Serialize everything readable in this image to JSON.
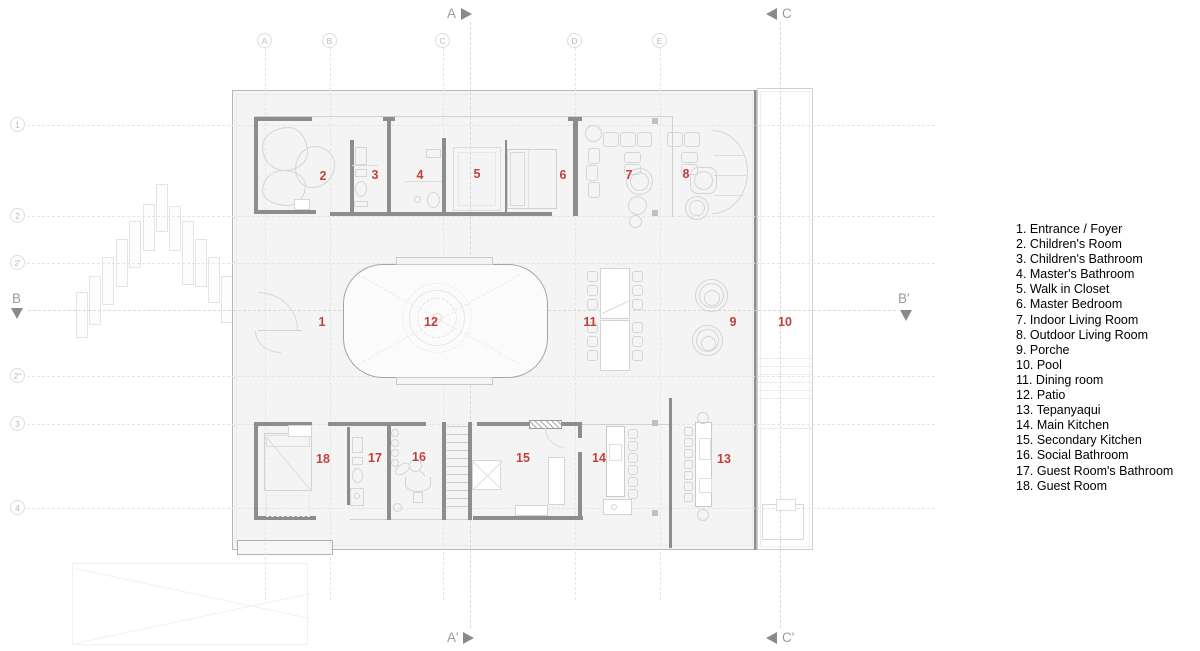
{
  "colors": {
    "room_number": "#c4403a",
    "wall": "#8d8d8d",
    "site_fill": "#f4f4f4",
    "grid_line": "#e5e5e5",
    "marker_text": "#9a9a9a"
  },
  "legend": {
    "items": [
      {
        "num": "1.",
        "label": "Entrance / Foyer"
      },
      {
        "num": "2.",
        "label": "Children's Room"
      },
      {
        "num": "3.",
        "label": "Children's Bathroom"
      },
      {
        "num": "4.",
        "label": "Master's Bathroom"
      },
      {
        "num": "5.",
        "label": "Walk in Closet"
      },
      {
        "num": "6.",
        "label": "Master Bedroom"
      },
      {
        "num": "7.",
        "label": "Indoor Living Room"
      },
      {
        "num": "8.",
        "label": "Outdoor Living Room"
      },
      {
        "num": "9.",
        "label": "Porche"
      },
      {
        "num": "10.",
        "label": "Pool"
      },
      {
        "num": "11.",
        "label": "Dining room"
      },
      {
        "num": "12.",
        "label": "Patio"
      },
      {
        "num": "13.",
        "label": "Tepanyaqui"
      },
      {
        "num": "14.",
        "label": "Main Kitchen"
      },
      {
        "num": "15.",
        "label": "Secondary Kitchen"
      },
      {
        "num": "16.",
        "label": "Social Bathroom"
      },
      {
        "num": "17.",
        "label": "Guest Room's Bathroom"
      },
      {
        "num": "18.",
        "label": "Guest Room"
      }
    ]
  },
  "grid": {
    "columns": [
      {
        "label": "A",
        "x": 265
      },
      {
        "label": "B",
        "x": 330
      },
      {
        "label": "C",
        "x": 443
      },
      {
        "label": "D",
        "x": 575
      },
      {
        "label": "E",
        "x": 660
      }
    ],
    "rows": [
      {
        "label": "1",
        "y": 125
      },
      {
        "label": "2",
        "y": 216
      },
      {
        "label": "2'",
        "y": 263
      },
      {
        "label": "2\"",
        "y": 376
      },
      {
        "label": "3",
        "y": 424
      },
      {
        "label": "4",
        "y": 508
      }
    ]
  },
  "sections": {
    "top_left": "A",
    "top_right": "C",
    "bottom_left": "A'",
    "bottom_right": "C'",
    "left": "B",
    "right": "B'"
  },
  "rooms": [
    {
      "num": "1",
      "x": 322,
      "y": 322
    },
    {
      "num": "2",
      "x": 323,
      "y": 176
    },
    {
      "num": "3",
      "x": 375,
      "y": 175
    },
    {
      "num": "4",
      "x": 420,
      "y": 175
    },
    {
      "num": "5",
      "x": 477,
      "y": 174
    },
    {
      "num": "6",
      "x": 563,
      "y": 175
    },
    {
      "num": "7",
      "x": 629,
      "y": 175
    },
    {
      "num": "8",
      "x": 686,
      "y": 174
    },
    {
      "num": "9",
      "x": 733,
      "y": 322
    },
    {
      "num": "10",
      "x": 785,
      "y": 322
    },
    {
      "num": "11",
      "x": 590,
      "y": 322
    },
    {
      "num": "12",
      "x": 431,
      "y": 322
    },
    {
      "num": "13",
      "x": 724,
      "y": 459
    },
    {
      "num": "14",
      "x": 599,
      "y": 458
    },
    {
      "num": "15",
      "x": 523,
      "y": 458
    },
    {
      "num": "16",
      "x": 419,
      "y": 457
    },
    {
      "num": "17",
      "x": 375,
      "y": 458
    },
    {
      "num": "18",
      "x": 323,
      "y": 459
    }
  ]
}
